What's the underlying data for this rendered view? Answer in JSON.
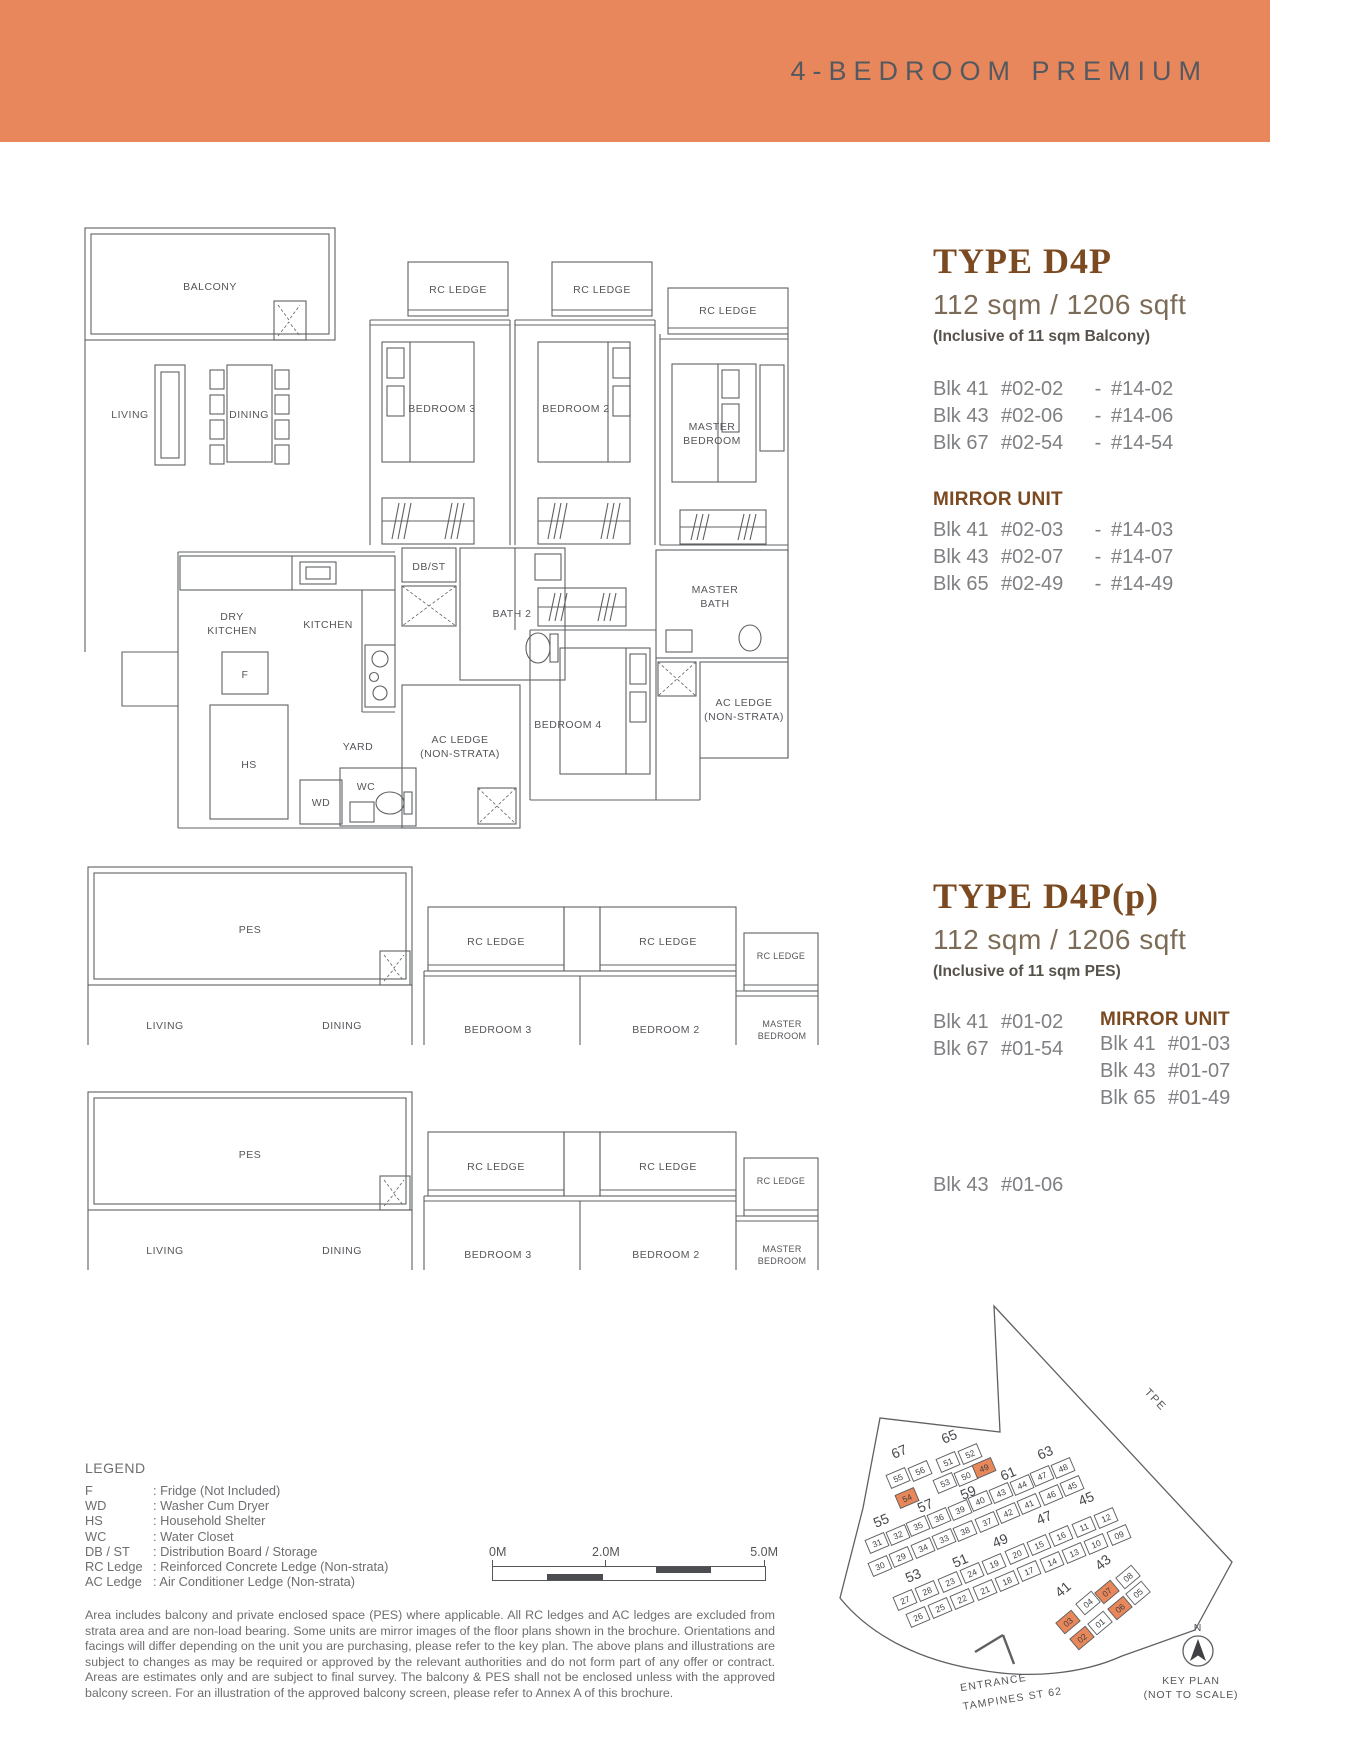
{
  "banner": {
    "title": "4-BEDROOM PREMIUM",
    "bg_color": "#E8875C"
  },
  "colors": {
    "heading_brown": "#7B4A21",
    "body_gray": "#7E8083",
    "legend_gray": "#6D6E71",
    "plan_line": "#5E6063",
    "highlight_orange": "#E8875A"
  },
  "type_d4p": {
    "title": "TYPE D4P",
    "area": "112 sqm / 1206 sqft",
    "area_note": "(Inclusive of 11 sqm Balcony)",
    "separator": "-",
    "units": [
      {
        "blk": "Blk 41",
        "from": "#02-02",
        "to": "#14-02"
      },
      {
        "blk": "Blk 43",
        "from": "#02-06",
        "to": "#14-06"
      },
      {
        "blk": "Blk 67",
        "from": "#02-54",
        "to": "#14-54"
      }
    ],
    "mirror_title": "MIRROR UNIT",
    "mirror_units": [
      {
        "blk": "Blk 41",
        "from": "#02-03",
        "to": "#14-03"
      },
      {
        "blk": "Blk 43",
        "from": "#02-07",
        "to": "#14-07"
      },
      {
        "blk": "Blk 65",
        "from": "#02-49",
        "to": "#14-49"
      }
    ]
  },
  "type_d4p_p": {
    "title": "TYPE D4P(p)",
    "area": "112 sqm / 1206 sqft",
    "area_note": "(Inclusive of 11 sqm PES)",
    "units": [
      {
        "blk": "Blk 41",
        "num": "#01-02"
      },
      {
        "blk": "Blk 67",
        "num": "#01-54"
      }
    ],
    "mirror_title": "MIRROR UNIT",
    "mirror_units": [
      {
        "blk": "Blk 41",
        "num": "#01-03"
      },
      {
        "blk": "Blk 43",
        "num": "#01-07"
      },
      {
        "blk": "Blk 65",
        "num": "#01-49"
      }
    ],
    "extra_unit": {
      "blk": "Blk 43",
      "num": "#01-06"
    }
  },
  "rooms": {
    "balcony": "BALCONY",
    "pes": "PES",
    "living": "LIVING",
    "dining": "DINING",
    "rc_ledge": "RC LEDGE",
    "bedroom3": "BEDROOM 3",
    "bedroom2": "BEDROOM 2",
    "bedroom4": "BEDROOM 4",
    "master_bedroom_1": "MASTER",
    "master_bedroom_2": "BEDROOM",
    "dry_kitchen_1": "DRY",
    "dry_kitchen_2": "KITCHEN",
    "kitchen": "KITCHEN",
    "db_st": "DB/ST",
    "bath2": "BATH 2",
    "master_bath_1": "MASTER",
    "master_bath_2": "BATH",
    "ac_ledge_1": "AC LEDGE",
    "ac_ledge_2": "(NON-STRATA)",
    "yard": "YARD",
    "wd": "WD",
    "wc": "WC",
    "hs": "HS",
    "fridge": "F"
  },
  "legend": {
    "title": "LEGEND",
    "entries": [
      {
        "abbr": "F",
        "desc": ": Fridge (Not Included)"
      },
      {
        "abbr": "WD",
        "desc": ": Washer Cum Dryer"
      },
      {
        "abbr": "HS",
        "desc": ": Household Shelter"
      },
      {
        "abbr": "WC",
        "desc": ": Water Closet"
      },
      {
        "abbr": "DB / ST",
        "desc": ": Distribution Board / Storage"
      },
      {
        "abbr": "RC Ledge",
        "desc": ": Reinforced Concrete Ledge (Non-strata)"
      },
      {
        "abbr": "AC Ledge",
        "desc": ": Air Conditioner Ledge (Non-strata)"
      }
    ]
  },
  "scale_bar": {
    "start": "0M",
    "mid": "2.0M",
    "end": "5.0M"
  },
  "disclaimer": "Area includes balcony and private enclosed space (PES) where applicable. All RC ledges and AC ledges are excluded from strata area and are non-load bearing. Some units are mirror images of the floor plans shown in the brochure. Orientations and facings will differ depending on the unit you are purchasing, please refer to the key plan. The above plans and illustrations are subject to changes as may be required or approved by the relevant authorities and do not form part of any offer or contract. Areas are estimates only and are subject to final survey. The balcony & PES shall not be enclosed unless with the approved balcony screen. For an illustration of the approved balcony screen, please refer to Annex A of this brochure.",
  "key_plan": {
    "highlight_color": "#E8875A",
    "tpe_label": "TPE",
    "entrance_line1": "ENTRANCE",
    "entrance_line2": "TAMPINES ST 62",
    "compass": "N",
    "caption_line1": "KEY PLAN",
    "caption_line2": "(NOT TO SCALE)",
    "blocks": [
      {
        "n": "67",
        "x": 131,
        "y": 166
      },
      {
        "n": "65",
        "x": 181,
        "y": 151
      },
      {
        "n": "63",
        "x": 277,
        "y": 167
      },
      {
        "n": "61",
        "x": 240,
        "y": 188
      },
      {
        "n": "59",
        "x": 200,
        "y": 207
      },
      {
        "n": "57",
        "x": 157,
        "y": 220
      },
      {
        "n": "55",
        "x": 113,
        "y": 235
      },
      {
        "n": "53",
        "x": 145,
        "y": 290
      },
      {
        "n": "51",
        "x": 192,
        "y": 275
      },
      {
        "n": "49",
        "x": 232,
        "y": 255
      },
      {
        "n": "47",
        "x": 276,
        "y": 232
      },
      {
        "n": "45",
        "x": 318,
        "y": 213
      },
      {
        "n": "43",
        "x": 336,
        "y": 276,
        "r": -40
      },
      {
        "n": "41",
        "x": 296,
        "y": 303,
        "r": -40
      }
    ],
    "units": [
      {
        "n": "55",
        "x": 128,
        "y": 188
      },
      {
        "n": "56",
        "x": 150,
        "y": 181
      },
      {
        "n": "54",
        "x": 137,
        "y": 208,
        "hl": true
      },
      {
        "n": "51",
        "x": 178,
        "y": 172
      },
      {
        "n": "52",
        "x": 200,
        "y": 164
      },
      {
        "n": "53",
        "x": 175,
        "y": 193
      },
      {
        "n": "50",
        "x": 196,
        "y": 186
      },
      {
        "n": "49",
        "x": 214,
        "y": 178,
        "hl": true
      },
      {
        "n": "31",
        "x": 107,
        "y": 253
      },
      {
        "n": "32",
        "x": 128,
        "y": 245
      },
      {
        "n": "35",
        "x": 148,
        "y": 236
      },
      {
        "n": "36",
        "x": 169,
        "y": 228
      },
      {
        "n": "39",
        "x": 190,
        "y": 220
      },
      {
        "n": "40",
        "x": 210,
        "y": 211
      },
      {
        "n": "43",
        "x": 231,
        "y": 203
      },
      {
        "n": "44",
        "x": 252,
        "y": 195
      },
      {
        "n": "47",
        "x": 272,
        "y": 186
      },
      {
        "n": "48",
        "x": 293,
        "y": 178
      },
      {
        "n": "30",
        "x": 110,
        "y": 276
      },
      {
        "n": "29",
        "x": 131,
        "y": 267
      },
      {
        "n": "34",
        "x": 153,
        "y": 258
      },
      {
        "n": "33",
        "x": 174,
        "y": 249
      },
      {
        "n": "38",
        "x": 195,
        "y": 241
      },
      {
        "n": "37",
        "x": 217,
        "y": 232
      },
      {
        "n": "42",
        "x": 238,
        "y": 223
      },
      {
        "n": "41",
        "x": 259,
        "y": 214
      },
      {
        "n": "46",
        "x": 281,
        "y": 205
      },
      {
        "n": "45",
        "x": 302,
        "y": 196
      },
      {
        "n": "27",
        "x": 135,
        "y": 310
      },
      {
        "n": "28",
        "x": 157,
        "y": 301
      },
      {
        "n": "23",
        "x": 180,
        "y": 292
      },
      {
        "n": "24",
        "x": 202,
        "y": 283
      },
      {
        "n": "19",
        "x": 224,
        "y": 274
      },
      {
        "n": "20",
        "x": 247,
        "y": 264
      },
      {
        "n": "15",
        "x": 269,
        "y": 255
      },
      {
        "n": "16",
        "x": 291,
        "y": 246
      },
      {
        "n": "11",
        "x": 314,
        "y": 237
      },
      {
        "n": "12",
        "x": 336,
        "y": 228
      },
      {
        "n": "26",
        "x": 148,
        "y": 327
      },
      {
        "n": "25",
        "x": 170,
        "y": 318
      },
      {
        "n": "22",
        "x": 192,
        "y": 309
      },
      {
        "n": "21",
        "x": 215,
        "y": 300
      },
      {
        "n": "18",
        "x": 237,
        "y": 291
      },
      {
        "n": "17",
        "x": 259,
        "y": 281
      },
      {
        "n": "14",
        "x": 282,
        "y": 272
      },
      {
        "n": "13",
        "x": 304,
        "y": 263
      },
      {
        "n": "10",
        "x": 326,
        "y": 254
      },
      {
        "n": "09",
        "x": 349,
        "y": 245
      },
      {
        "n": "04",
        "x": 318,
        "y": 313,
        "r": -40
      },
      {
        "n": "07",
        "x": 337,
        "y": 302,
        "hl": true,
        "r": -40
      },
      {
        "n": "08",
        "x": 358,
        "y": 287,
        "r": -40
      },
      {
        "n": "05",
        "x": 368,
        "y": 303,
        "r": -40
      },
      {
        "n": "03",
        "x": 298,
        "y": 332,
        "hl": true,
        "r": -40
      },
      {
        "n": "01",
        "x": 330,
        "y": 333,
        "r": -40
      },
      {
        "n": "06",
        "x": 350,
        "y": 318,
        "hl": true,
        "r": -40
      },
      {
        "n": "02",
        "x": 312,
        "y": 348,
        "hl": true,
        "r": -40
      }
    ]
  }
}
